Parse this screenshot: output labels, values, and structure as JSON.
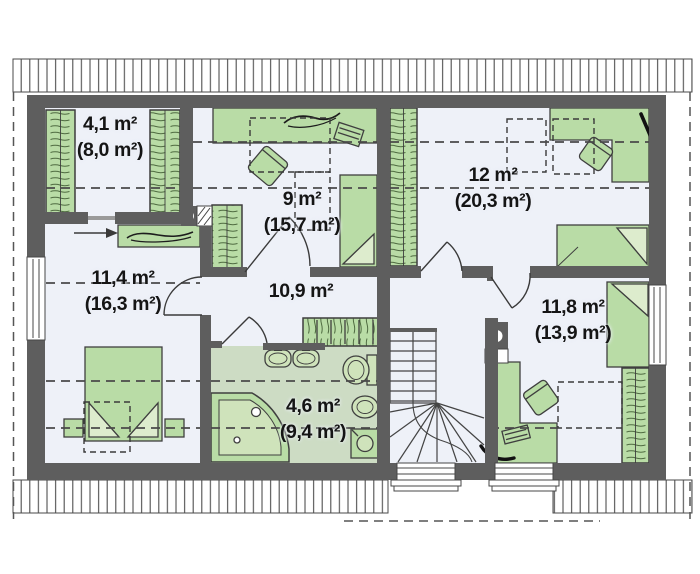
{
  "canvas": {
    "width": 700,
    "height": 574,
    "background": "#ffffff"
  },
  "colors": {
    "wall": "#5e5e5e",
    "floor": "#eef1f8",
    "bathroom_floor": "#cddcc4",
    "furniture_fill": "#b9dca6",
    "furniture_stroke": "#3f3f3f",
    "fixture_fill": "#cfe3bb",
    "dashed_line": "#4a4a4a",
    "label_text": "#151515"
  },
  "rooms": [
    {
      "id": "wardrobe-closet",
      "label": "4,1 m²",
      "sublabel": "(8,0 m²)"
    },
    {
      "id": "bedroom-top-middle",
      "label": "9 m²",
      "sublabel": "(15,7 m²)"
    },
    {
      "id": "bedroom-top-right",
      "label": "12 m²",
      "sublabel": "(20,3 m²)"
    },
    {
      "id": "bedroom-left",
      "label": "11,4 m²",
      "sublabel": "(16,3 m²)"
    },
    {
      "id": "hallway",
      "label": "10,9 m²",
      "sublabel": ""
    },
    {
      "id": "bathroom",
      "label": "4,6 m²",
      "sublabel": "(9,4 m²)"
    },
    {
      "id": "bedroom-bottom-right",
      "label": "11,8 m²",
      "sublabel": "(13,9 m²)"
    }
  ],
  "furniture_icons": [
    "wardrobe",
    "bed",
    "desk",
    "chair",
    "nightstand",
    "dresser",
    "double-washbasin",
    "toilet",
    "bidet",
    "washing-machine",
    "corner-bathtub",
    "winder-staircase",
    "chimney-flue",
    "roof-window-dashed",
    "entrance-arrow"
  ]
}
